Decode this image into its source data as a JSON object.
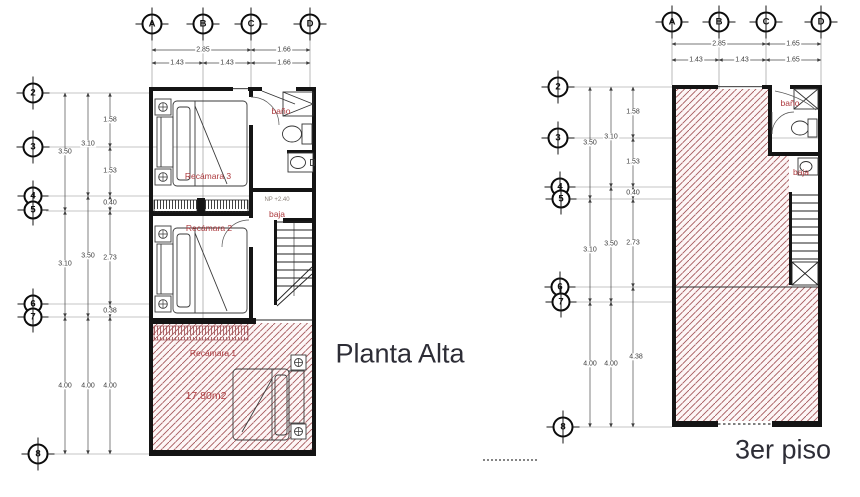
{
  "left_plan": {
    "title": "Planta Alta",
    "grid_cols": [
      "A",
      "B",
      "C",
      "D"
    ],
    "grid_rows": [
      "2",
      "3",
      "4",
      "5",
      "6",
      "7",
      "8"
    ],
    "dims": {
      "top_row1": [
        "2.85",
        "1.66"
      ],
      "top_row2": [
        "1.43",
        "1.43",
        "1.66"
      ],
      "col1": [
        "3.50",
        "3.10",
        "4.00"
      ],
      "col2": [
        "3.10",
        "3.50",
        "4.00"
      ],
      "col3": [
        "1.58",
        "1.53",
        "0.40",
        "2.73",
        "0.38",
        "4.00"
      ]
    },
    "labels": {
      "recamara3": "Recámara 3",
      "recamara2": "Recámara 2",
      "recamara1": "Recámara 1",
      "area": "17.80m2",
      "bano": "baño",
      "baja": "baja",
      "level_note": "NP +2.40"
    }
  },
  "right_plan": {
    "title": "3er piso",
    "grid_cols": [
      "A",
      "B",
      "C",
      "D"
    ],
    "grid_rows": [
      "2",
      "3",
      "4",
      "5",
      "6",
      "7",
      "8"
    ],
    "dims": {
      "top_row1": [
        "2.85",
        "1.65"
      ],
      "top_row2": [
        "1.43",
        "1.43",
        "1.65"
      ],
      "col1": [
        "3.50",
        "3.10",
        "4.00"
      ],
      "col2": [
        "3.10",
        "3.50",
        "4.00"
      ],
      "col3": [
        "1.58",
        "1.53",
        "0.40",
        "2.73",
        "4.38"
      ]
    },
    "labels": {
      "bano": "baño",
      "baja": "baja"
    }
  },
  "colors": {
    "wall": "#141414",
    "hatch_line": "#a4575b",
    "hatch_bg": "#fdf6f6",
    "label_red": "#ad3a3e",
    "dim_text": "#3c3c3c",
    "title_text": "#2d2d36"
  }
}
